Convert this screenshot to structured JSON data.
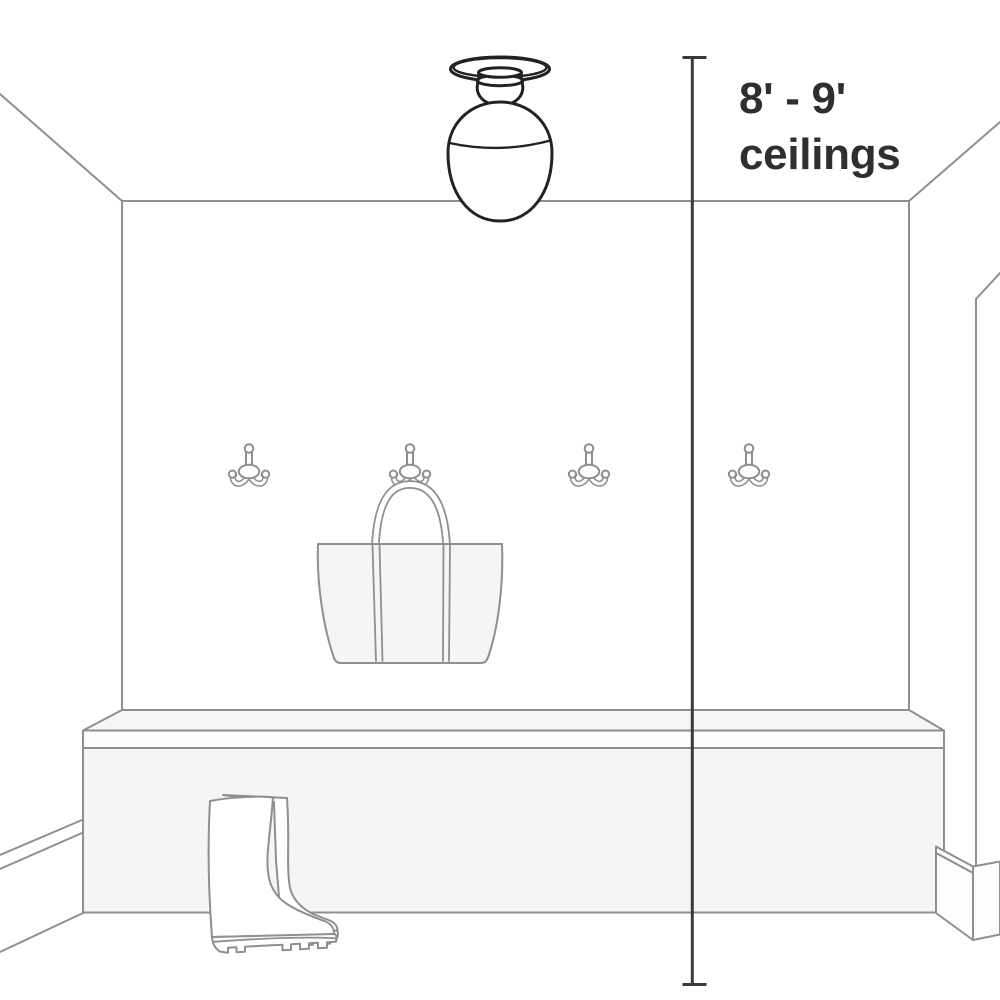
{
  "illustration": {
    "type": "room-scale-diagram",
    "subject": "entryway mudroom with semi-flush ceiling light over bench, coat hooks, tote bag and rain boots",
    "annotation": {
      "line1": "8' - 9'",
      "line2": "ceilings"
    },
    "measurement": {
      "style": "vertical line with end caps",
      "spans": "ceiling fixture to floor"
    },
    "objects": {
      "ceiling_light": "semi-flush mount light with egg-shaped glass shade",
      "coat_hook_count": 4,
      "tote_bag": "hanging on second hook",
      "bench": "built-in storage bench",
      "rain_boots": "pair of tall rain boots on floor"
    },
    "colors": {
      "background": "#ffffff",
      "room_line": "#8f8f8f",
      "fixture_line": "#222222",
      "measure_line": "#3a3a3a",
      "label_text": "#2f2f2f",
      "bag_fill": "#f5f5f5",
      "bench_top_fill": "#f6f6f6",
      "bench_band_fill": "#fcfcfc",
      "bench_front_fill": "#f5f5f5"
    }
  }
}
